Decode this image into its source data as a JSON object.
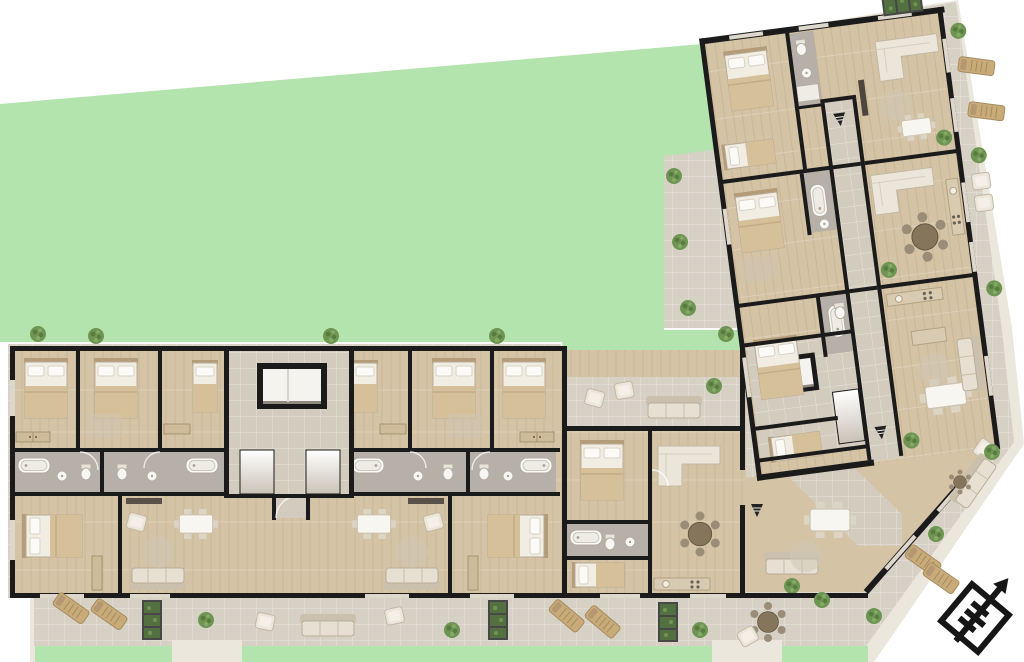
{
  "page": {
    "title": "Residential building floor plan",
    "type": "architectural color floor plan rendering, top view",
    "orientation_note": "L-shaped building: horizontal south wing and tilted east wing, large garden lawn in the north-west"
  },
  "colors": {
    "background": "#ffffff",
    "lawn": "#b4e4ae",
    "pavement": "#d6d0c5",
    "pavement_light": "#ece7dd",
    "wood_floor": "#d4c3a4",
    "wood_floor_dark": "#c9b18c",
    "bath_floor": "#b6b0a8",
    "corridor_floor": "#d3ccbe",
    "wall": "#1b1b1b",
    "window": "#ddd7cc",
    "furniture_cream": "#efe9dd",
    "furniture_tan": "#c8ab79",
    "sofa_gray": "#a59c8e",
    "plant_green": "#6f9553",
    "planter_green": "#527040",
    "elevator_cab": "#f5f3ef"
  },
  "plan": {
    "site": {
      "lawn_label": "garden lawn",
      "terrace_label": "paved terraces and balconies",
      "walkway_label": "perimeter walkway rim"
    },
    "wings": [
      {
        "name": "south wing",
        "orientation": "horizontal band along the bottom"
      },
      {
        "name": "east wing",
        "orientation": "vertical band tilted about 8 degrees"
      }
    ],
    "cores": [
      {
        "name": "stair and elevator core 1",
        "location": "center of south wing"
      },
      {
        "name": "stair and elevator core 2",
        "location": "junction of the two wings"
      }
    ],
    "room_types": [
      "bedroom",
      "living room",
      "bathroom",
      "kitchen / dining",
      "corridor",
      "terrace"
    ],
    "furniture_kinds": [
      "double bed",
      "single bed",
      "corner sofa",
      "sofa",
      "armchair",
      "round dining table with chairs",
      "rectangular dining table with chairs",
      "bathtub",
      "toilet",
      "sink",
      "wardrobe",
      "kitchen counter",
      "sun lounger",
      "outdoor seating set",
      "planter box",
      "potted plant",
      "rug"
    ]
  },
  "compass": {
    "name": "north arrow",
    "direction": "pointing upper-right (north-east)"
  }
}
